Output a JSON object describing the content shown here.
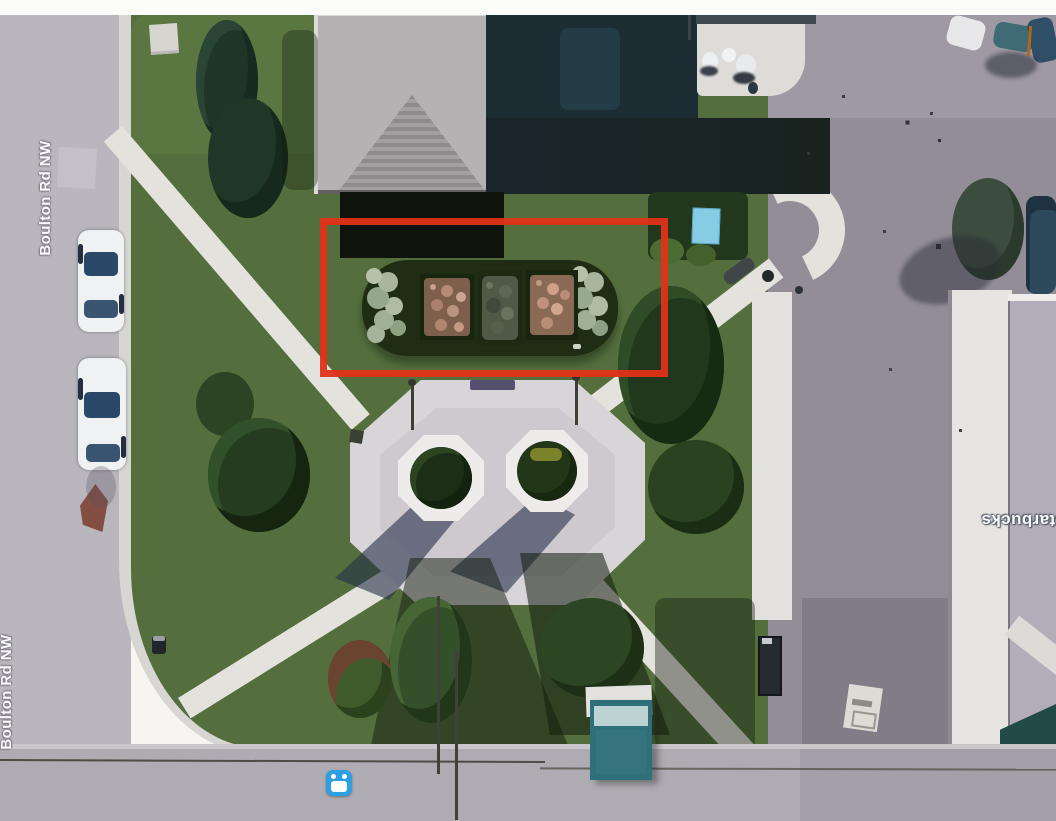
{
  "map": {
    "road_labels": [
      {
        "text": "Boulton Rd NW"
      },
      {
        "text": "Boulton Rd NW"
      }
    ],
    "place_label": {
      "text": "Starbucks"
    },
    "annotation_box": {
      "shape": "rectangle",
      "border_color": "#e23218",
      "highlights": "flower-bed planter"
    },
    "transit_marker": {
      "icon": "bus-icon",
      "color": "#2d9fe3"
    },
    "colors": {
      "lawn_green": "#546f3d",
      "road_gray": "#b9b6bd",
      "parking_gray": "#928d97",
      "sidewalk_white": "#e4e2dd",
      "dark_flat_roof": "#1c2d34",
      "light_hip_roof": "#b5b2b3",
      "annotation_red": "#e23218",
      "transit_blue": "#2d9fe3"
    }
  }
}
